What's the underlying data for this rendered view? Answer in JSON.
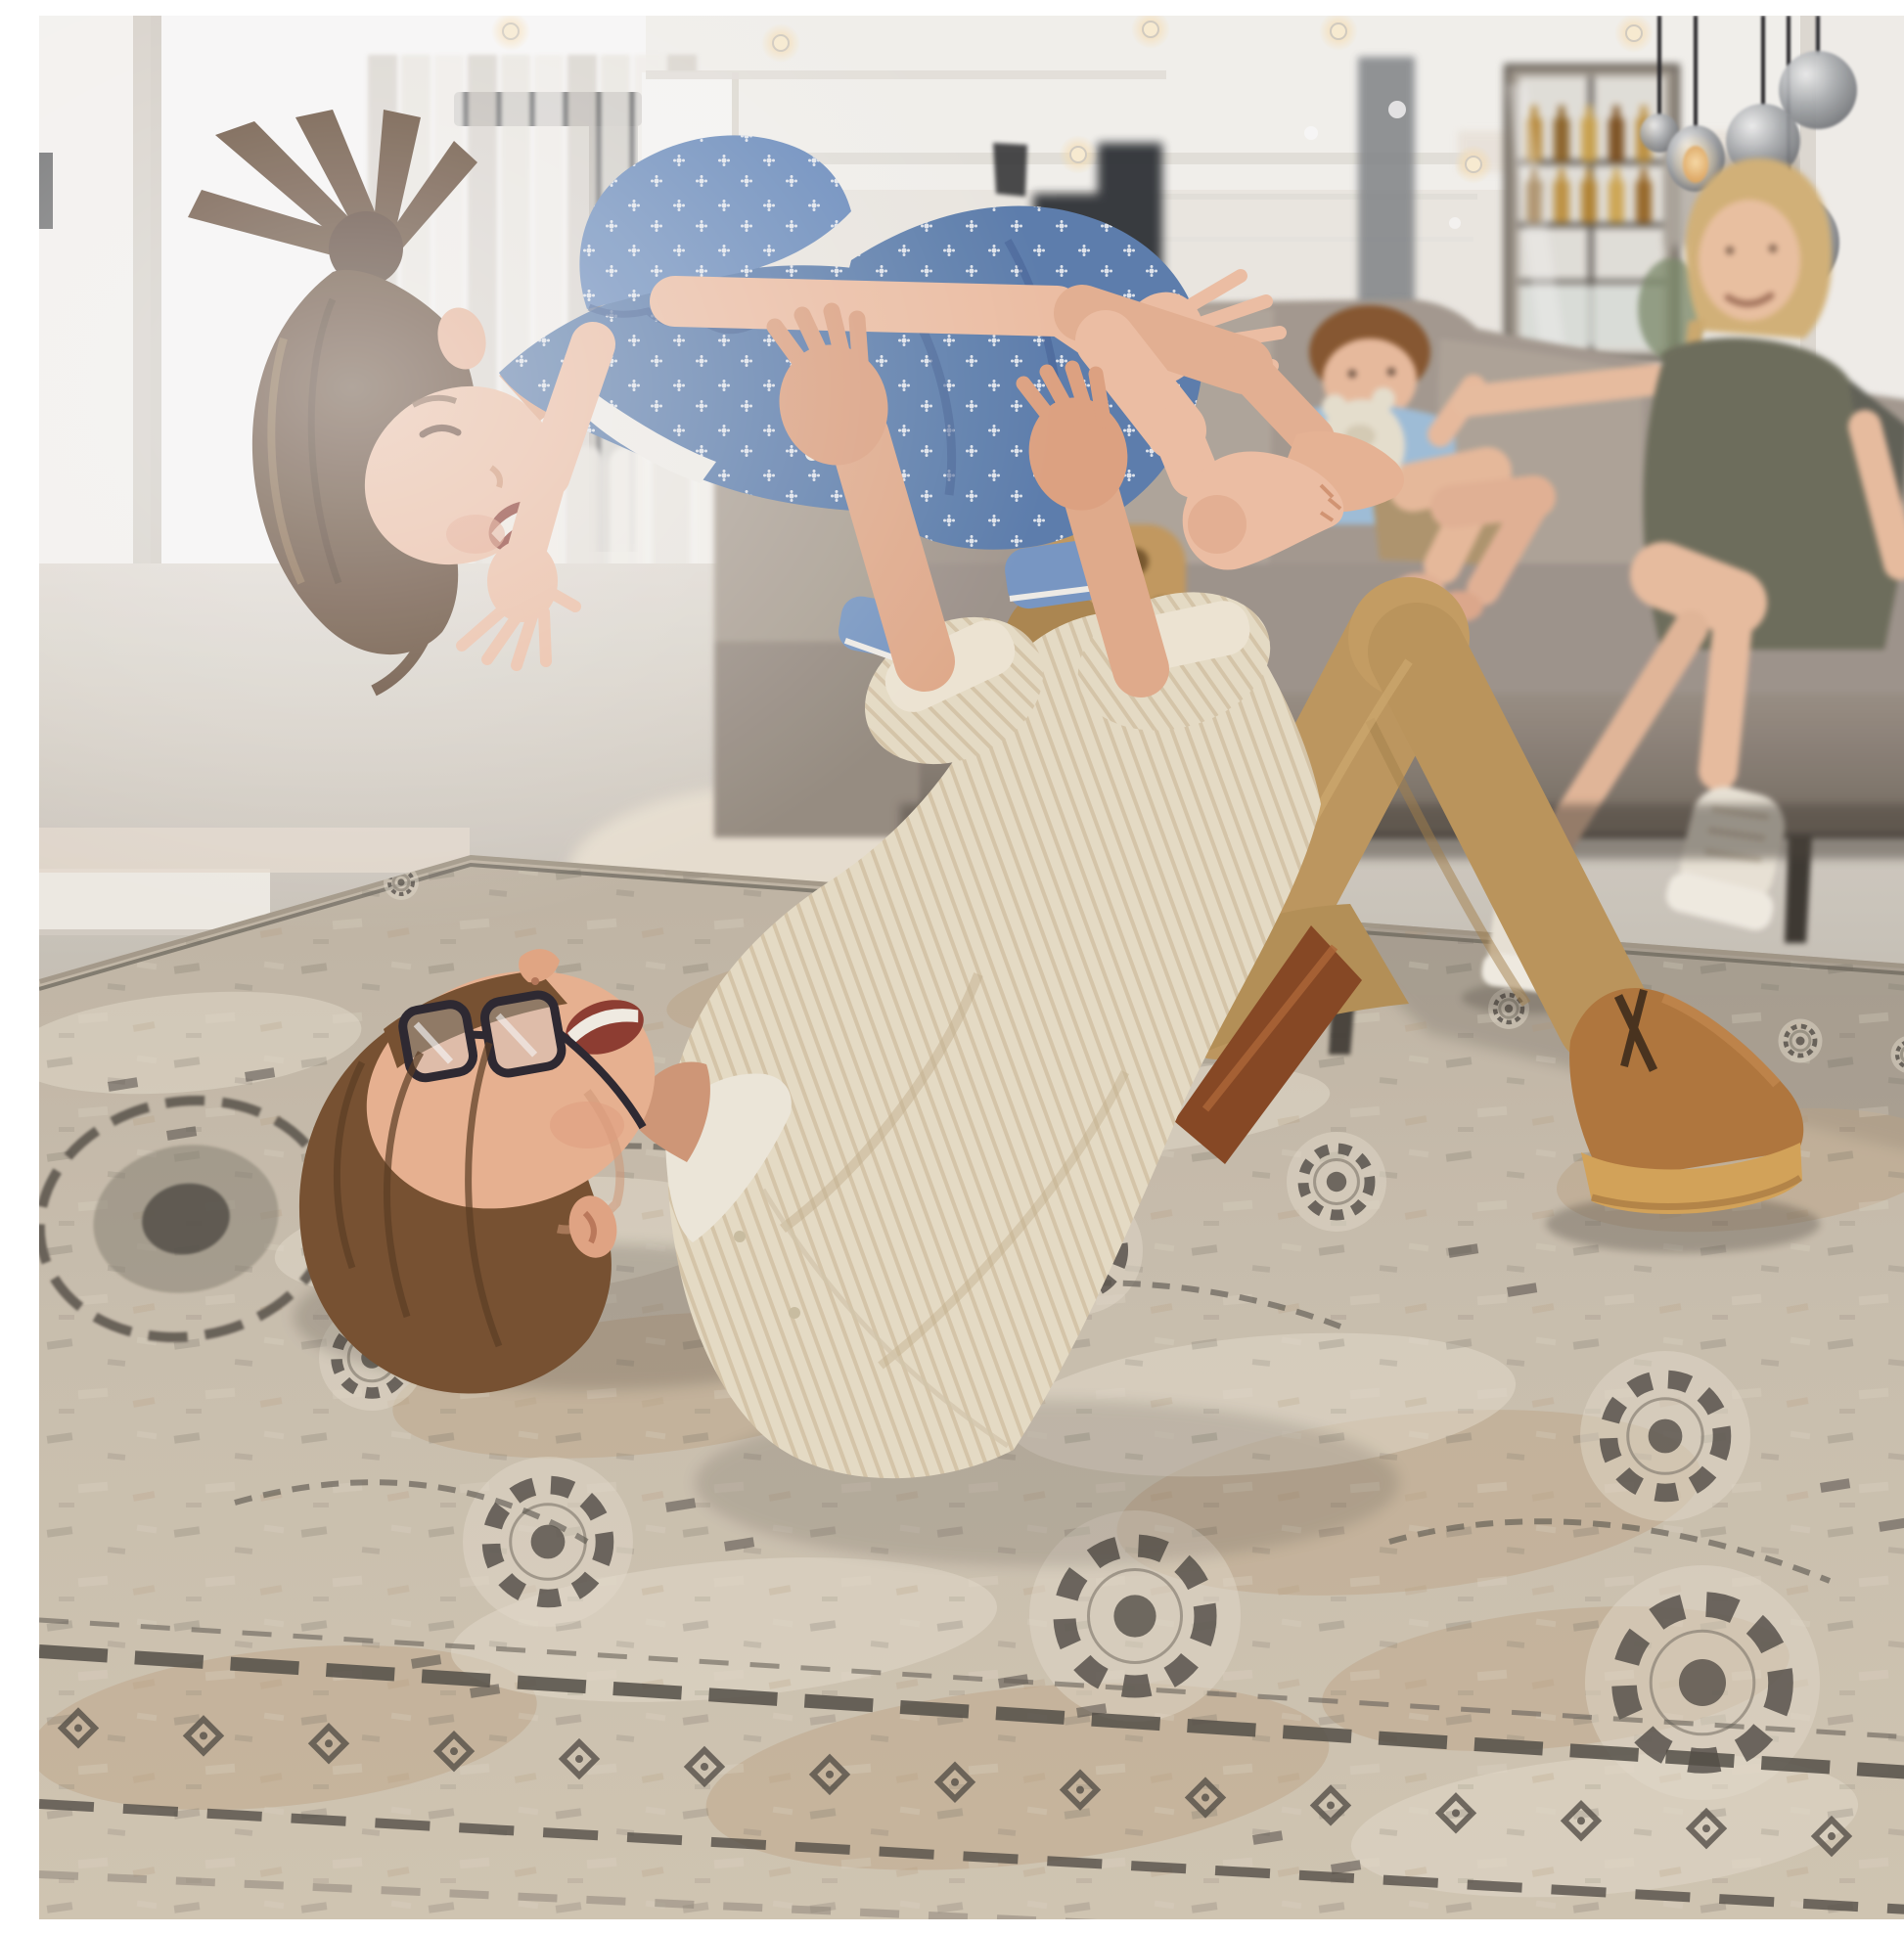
{
  "scene": {
    "type": "lifestyle-photograph",
    "description": "Bright modern living room: a father lies on his back on a large distressed vintage beige-and-grey area rug, lifting his laughing daughter overhead in an airplane pose, while the mother and toddler son watch from a grey sofa beneath smoked-glass pendant lights, a drinks cabinet and a floating black staircase.",
    "setting": "open-plan living room with white walls, tall black-framed window, sheer curtains and recessed ceiling spotlights",
    "mood": "playful family moment"
  },
  "people": {
    "father": {
      "pose": "lying on back on rug lifting child",
      "clothing": "cream striped shirt, khaki chinos, brown belt, tan suede desert boots",
      "accessory": "dark-framed glasses",
      "hair": "auburn"
    },
    "daughter": {
      "pose": "held aloft horizontally, arms spread, laughing",
      "clothing": "denim-blue floral romper",
      "hair": "brown ponytail",
      "feet": "bare"
    },
    "mother": {
      "pose": "sitting on sofa, legs crossed, smiling",
      "clothing": "olive-grey dress, beige sneakers",
      "hair": "blonde braid"
    },
    "son": {
      "pose": "toddler sitting on sofa hugging teddy bear",
      "clothing": "light-blue t-shirt, khaki shorts",
      "hair": "auburn"
    }
  },
  "objects": {
    "rug": {
      "style": "distressed vintage oriental",
      "colors": "beige, cream, grey, charcoal",
      "motifs": "medallions, gear rosettes, palmettes, border bands"
    },
    "sofa": {
      "type": "taupe-grey fabric sectional",
      "legs": "dark metal"
    },
    "pendant_lights": {
      "type": "smoked glass globes with one amber glowing teardrop",
      "cords": "black"
    },
    "bar_cabinet": {
      "type": "glass-front cabinet with amber bottles"
    },
    "staircase": {
      "type": "black floating stairs, blurred"
    },
    "window": {
      "frame": "black",
      "light": "overexposed daylight"
    },
    "curtains": {
      "type": "sheer white floor-length"
    },
    "teddy_bear": {
      "color": "cream"
    },
    "wood_stool": {
      "type": "carved wooden stool with round holes"
    },
    "ceiling_lights": {
      "type": "recessed warm spotlights"
    }
  },
  "palette": {
    "wall": "#f1eee8",
    "wall_bright": "#fbfaf7",
    "wall_warm": "#eadfd3",
    "ceiling": "#f8f7f3",
    "window_glass": "#ffffff",
    "window_frame": "#43464a",
    "curtain": "#f0ede6",
    "stairs": "#303439",
    "corridor": "#fdfdfb",
    "slot_grey": "#83878b",
    "pillar": "#f6f4f0",
    "pillar_shadow": "#d2cdc5",
    "floor": "#ddd7cd",
    "floor_dark": "#8f887e",
    "sofa": "#a89e94",
    "sofa_light": "#b4aaa0",
    "sofa_dark": "#7e756b",
    "sofa_leg": "#3f3b35",
    "rug_base": "#cdc3b2",
    "rug_cream": "#e7e0d0",
    "rug_beige": "#c2a88a",
    "rug_grey": "#8d8679",
    "rug_charcoal": "#56514a",
    "skin": "#eeb795",
    "skin_light": "#f3c4a9",
    "skin_shadow": "#d59c7b",
    "father_hair": "#7a5433",
    "father_shirt": "#ece2cb",
    "shirt_stripe": "#dbcbae",
    "chino": "#c29c62",
    "chino_dark": "#a8834e",
    "belt": "#8a4a26",
    "boot": "#b57a40",
    "boot_sole": "#d9a85c",
    "daughter_hair": "#5f4530",
    "dress_blue": "#5f82b2",
    "dress_light": "#7b9cc9",
    "dress_dark": "#47659a",
    "mother_hair": "#d8b77c",
    "mother_dress": "#70715f",
    "sneaker": "#efe9dc",
    "boy_hair": "#8a5a33",
    "boy_shirt": "#a3c3de",
    "boy_shorts": "#b39a72",
    "teddy": "#ece5d4",
    "pendant_smoke": "#9fa3a7",
    "pendant_amber": "#d89243",
    "bottle_amber": "#b8872f",
    "wood_stool": "#c79e63",
    "cord": "#26262a",
    "glasses": "#2e2a33",
    "mouth": "#913f33",
    "teeth": "#f7f3ea"
  }
}
